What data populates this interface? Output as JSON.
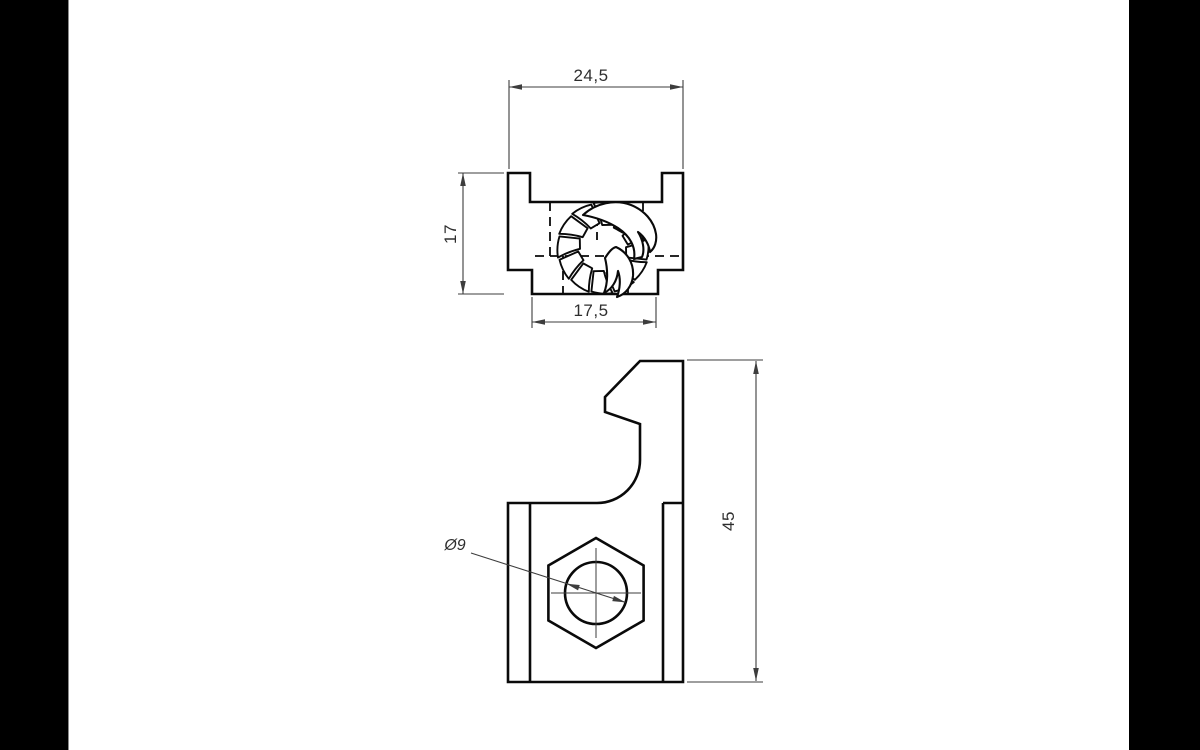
{
  "colors": {
    "letterbox": "#000000",
    "paper": "#ffffff",
    "line": "#0a0a0a",
    "thin": "#3d3d3d",
    "text": "#2e2e2e",
    "separator": "#8a8a8a"
  },
  "dims": {
    "overall_width": "24,5",
    "front_height": "17",
    "slot_width": "17,5",
    "hole_diameter": "Ø9",
    "side_height": "45"
  }
}
